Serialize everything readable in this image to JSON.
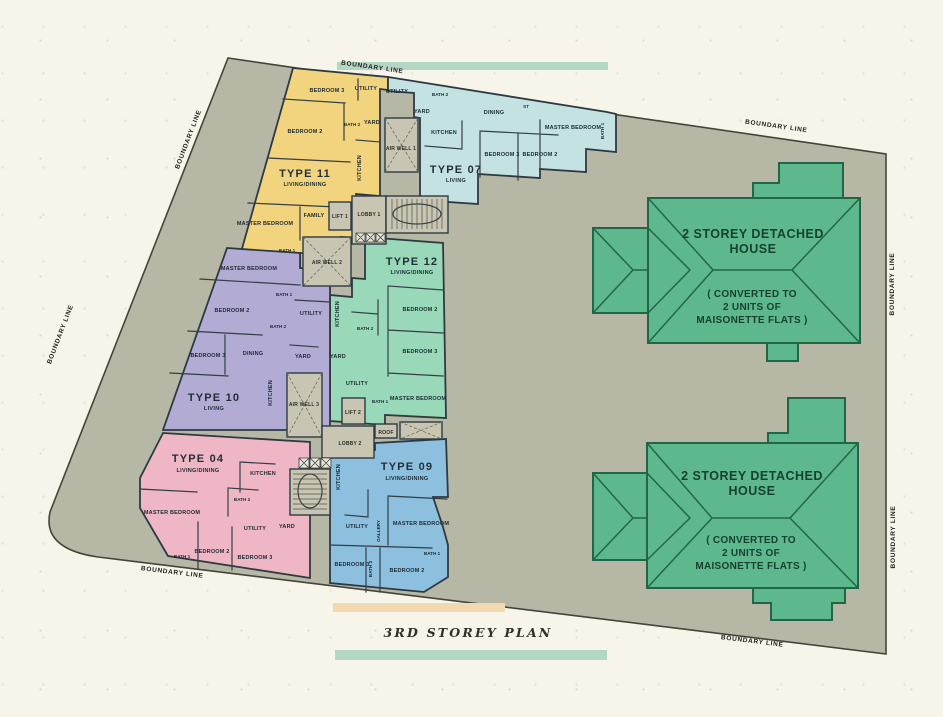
{
  "plan": {
    "title": "3RD STOREY PLAN",
    "boundary_label": "BOUNDARY LINE"
  },
  "units": {
    "t11": {
      "title": "TYPE 11",
      "subtitle": "LIVING/DINING",
      "rooms": {
        "bedroom2": "BEDROOM 2",
        "bedroom3": "BEDROOM 3",
        "master": "MASTER BEDROOM",
        "family": "FAMILY",
        "kitchen": "KITCHEN",
        "utility": "UTILITY",
        "yard": "YARD",
        "bath1": "BATH 1",
        "bath2": "BATH 2"
      }
    },
    "t07": {
      "title": "TYPE 07",
      "subtitle": "LIVING",
      "rooms": {
        "dining": "DINING",
        "st": "ST",
        "master": "MASTER BEDROOM",
        "bedroom2": "BEDROOM 2",
        "bedroom3": "BEDROOM 3",
        "kitchen": "KITCHEN",
        "utility": "UTILITY",
        "yard": "YARD",
        "bath1": "BATH 1",
        "bath2": "BATH 2"
      }
    },
    "t12": {
      "title": "TYPE 12",
      "subtitle": "LIVING/DINING",
      "rooms": {
        "bedroom2": "BEDROOM 2",
        "bedroom3": "BEDROOM 3",
        "master": "MASTER BEDROOM",
        "kitchen": "KITCHEN",
        "utility": "UTILITY",
        "yard": "YARD",
        "bath1": "BATH 1",
        "bath2": "BATH 2"
      }
    },
    "t10": {
      "title": "TYPE 10",
      "subtitle": "LIVING",
      "rooms": {
        "master": "MASTER BEDROOM",
        "bedroom2": "BEDROOM 2",
        "bedroom3": "BEDROOM 3",
        "dining": "DINING",
        "kitchen": "KITCHEN",
        "utility": "UTILITY",
        "yard": "YARD",
        "bath1": "BATH 1",
        "bath2": "BATH 2"
      }
    },
    "t04": {
      "title": "TYPE 04",
      "subtitle": "LIVING/DINING",
      "rooms": {
        "master": "MASTER BEDROOM",
        "bedroom2": "BEDROOM 2",
        "bedroom3": "BEDROOM 3",
        "kitchen": "KITCHEN",
        "utility": "UTILITY",
        "yard": "YARD",
        "bath1": "BATH 1",
        "bath2": "BATH 2"
      }
    },
    "t09": {
      "title": "TYPE 09",
      "subtitle": "LIVING/DINING",
      "rooms": {
        "master": "MASTER BEDROOM",
        "bedroom2": "BEDROOM 2",
        "bedroom3": "BEDROOM 3",
        "kitchen": "KITCHEN",
        "utility": "UTILITY",
        "gallery": "GALLERY",
        "bath1": "BATH 1",
        "bath2": "BATH 2"
      }
    }
  },
  "core": {
    "air_well_1": "AIR WELL 1",
    "air_well_2": "AIR WELL 2",
    "air_well_3": "AIR WELL 3",
    "lift_1": "LIFT 1",
    "lift_2": "LIFT 2",
    "lobby_1": "LOBBY 1",
    "lobby_2": "LOBBY 2",
    "roof": "ROOF"
  },
  "house": {
    "name_line1": "2 STOREY DETACHED",
    "name_line2": "HOUSE",
    "note_line1": "( CONVERTED TO",
    "note_line2": "2 UNITS OF",
    "note_line3": "MAISONETTE FLATS )"
  },
  "colors": {
    "paper": "#f7f5ea",
    "plot": "#b7b7a6",
    "core": "#c8c5b2",
    "type11": "#f2d47e",
    "type07": "#c5e2e2",
    "type12": "#99d9b9",
    "type10": "#b2abd4",
    "type04": "#efb6c6",
    "type09": "#8dbfdf",
    "house": "#5eb88d",
    "house_stroke": "#226648",
    "bar_teal": "#b3d6c5",
    "bar_orange": "#f3d9b2"
  }
}
